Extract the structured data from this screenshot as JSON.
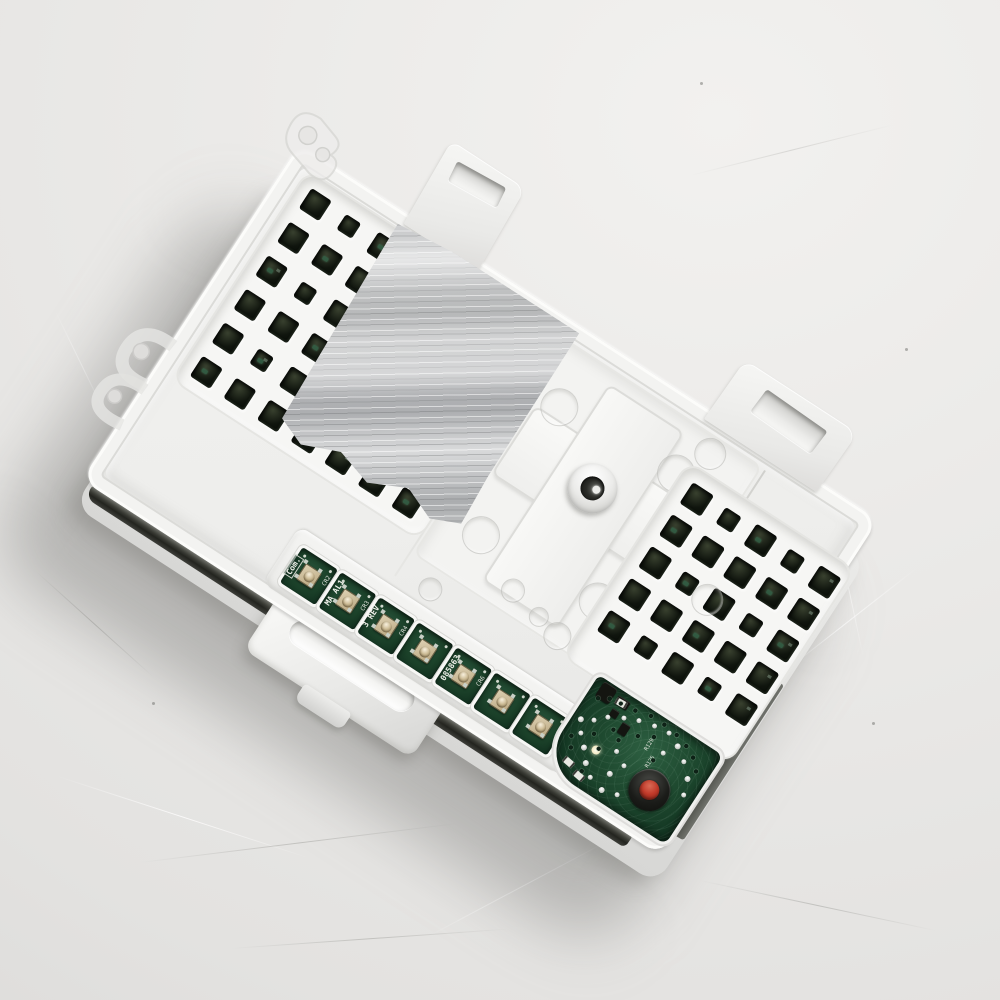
{
  "scene": {
    "description": "Top-down product photo of a white plastic washer electronic control board lying on a light grey scratched surface, rotated about 33 degrees, with foil tape, vent hole grids, a row of green PCB tactile-switch windows and an exposed PCB corner with a red test button",
    "board_rotation_deg": 33
  },
  "colors": {
    "background": "#e9e8e6",
    "housing_white": "#f2f2f0",
    "foil_tape_grey": "#b4b6b7",
    "pcb_green": "#1e492f",
    "vent_hole_black": "#10150e",
    "red_button": "#c13a2a",
    "switch_dome_beige": "#cdbc96",
    "gap_shadow": "#23241f"
  },
  "pcb": {
    "windows": [
      {
        "label": "Com.",
        "ref": "CR2"
      },
      {
        "label": "MA AL1",
        "ref": "CR3"
      },
      {
        "label": "3 REV",
        "ref": "CR4"
      },
      {
        "label": "",
        "ref": ""
      },
      {
        "label": "085863",
        "ref": "CR6"
      },
      {
        "label": "",
        "ref": ""
      },
      {
        "label": "",
        "ref": ""
      }
    ],
    "silk_labels": [
      "R129",
      "R125"
    ]
  },
  "grids": {
    "left": {
      "cols": 7,
      "rows": 6,
      "hole": 24,
      "pitch": 40,
      "x0": 12,
      "y0": 12
    },
    "right": {
      "cols": 5,
      "rows": 5,
      "hole": 25,
      "pitch": 38,
      "x0": 14,
      "y0": 14
    }
  }
}
